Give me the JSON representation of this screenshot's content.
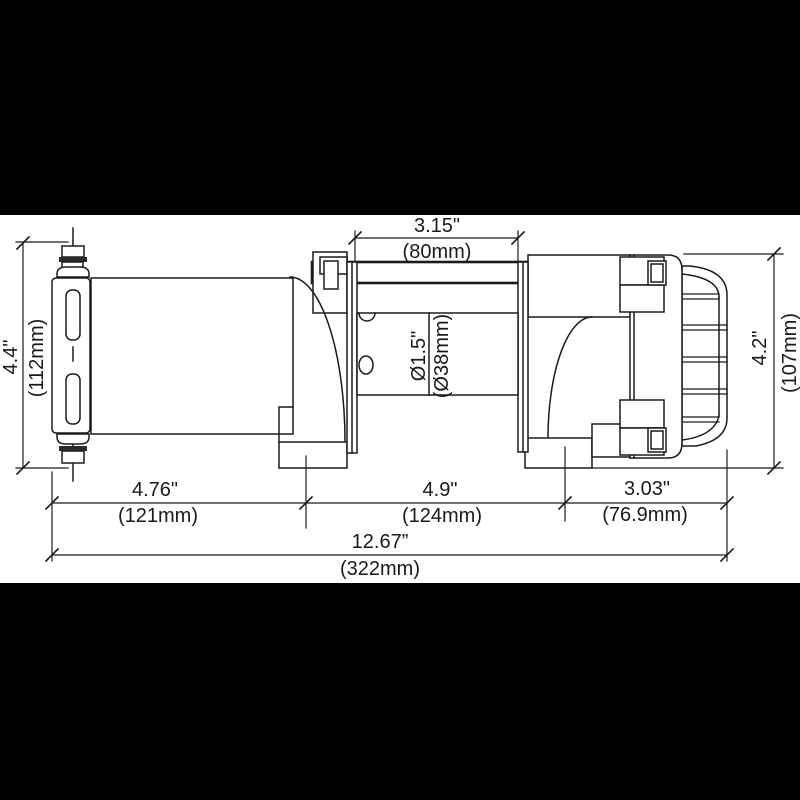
{
  "diagram_title": "electric winch dimensional drawing",
  "colors": {
    "line": "#1b1b1b",
    "paper": "#ffffff",
    "matte": "#000000"
  },
  "dims": {
    "drum_width": {
      "in": "3.15\"",
      "mm": "(80mm)"
    },
    "left_height": {
      "in": "4.4\"",
      "mm": "(112mm)"
    },
    "right_height": {
      "in": "4.2\"",
      "mm": "(107mm)"
    },
    "drum_diameter": {
      "in": "Ø1.5\"",
      "mm": "(Ø38mm)"
    },
    "motor_section": {
      "in": "4.76\"",
      "mm": "(121mm)"
    },
    "drum_section": {
      "in": "4.9\"",
      "mm": "(124mm)"
    },
    "gear_section": {
      "in": "3.03\"",
      "mm": "(76.9mm)"
    },
    "overall_length": {
      "in": "12.67”",
      "mm": "(322mm)"
    }
  }
}
